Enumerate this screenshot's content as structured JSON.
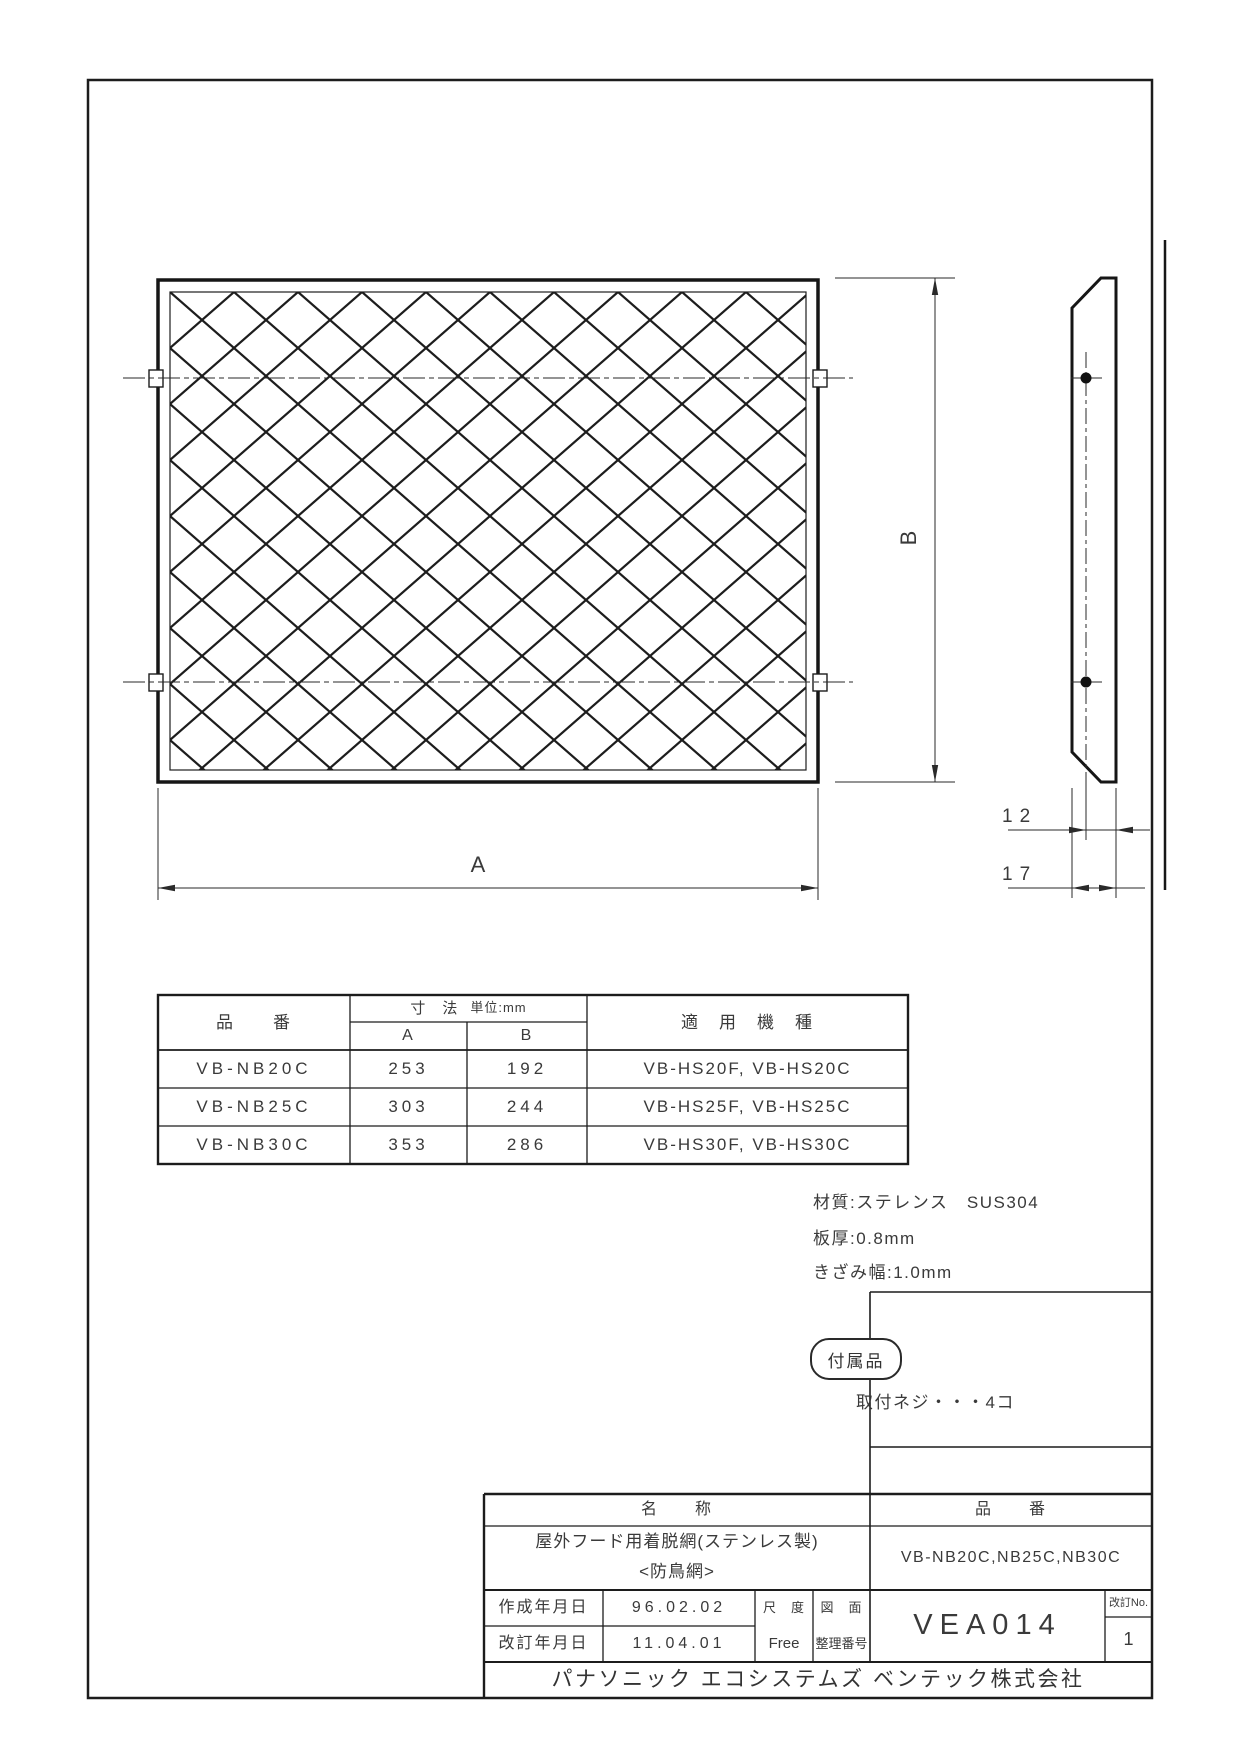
{
  "drawing_labels": {
    "dim_a": "A",
    "dim_b": "B",
    "dim_screw_depth": "12",
    "dim_total_depth": "17"
  },
  "parts_table": {
    "header": {
      "part_no": "品　　番",
      "dims": "寸　法",
      "unit": "単位:mm",
      "col_a": "A",
      "col_b": "B",
      "models": "適　用　機　種"
    },
    "rows": [
      {
        "part_no": "VB-NB20C",
        "a": "253",
        "b": "192",
        "models": "VB-HS20F, VB-HS20C"
      },
      {
        "part_no": "VB-NB25C",
        "a": "303",
        "b": "244",
        "models": "VB-HS25F, VB-HS25C"
      },
      {
        "part_no": "VB-NB30C",
        "a": "353",
        "b": "286",
        "models": "VB-HS30F, VB-HS30C"
      }
    ]
  },
  "notes": {
    "material": "材質:ステレンス　SUS304",
    "thickness": "板厚:0.8mm",
    "notch_width": "きざみ幅:1.0mm"
  },
  "accessories": {
    "label": "付属品",
    "item": "取付ネジ・・・4コ"
  },
  "title_block": {
    "name_label": "名　　称",
    "name_line1": "屋外フード用着脱網(ステンレス製)",
    "name_line2": "<防鳥網>",
    "part_no_label": "品　　番",
    "part_no_value": "VB-NB20C,NB25C,NB30C",
    "created_label": "作成年月日",
    "created_date": "96.02.02",
    "revised_label": "改訂年月日",
    "revised_date": "11.04.01",
    "scale_label": "尺　度",
    "scale_value": "Free",
    "drawing_no_label_1": "図　面",
    "drawing_no_label_2": "整理番号",
    "drawing_no": "VEA014",
    "rev_label": "改訂No.",
    "rev_value": "1",
    "company": "パナソニック エコシステムズ ベンテック株式会社"
  }
}
